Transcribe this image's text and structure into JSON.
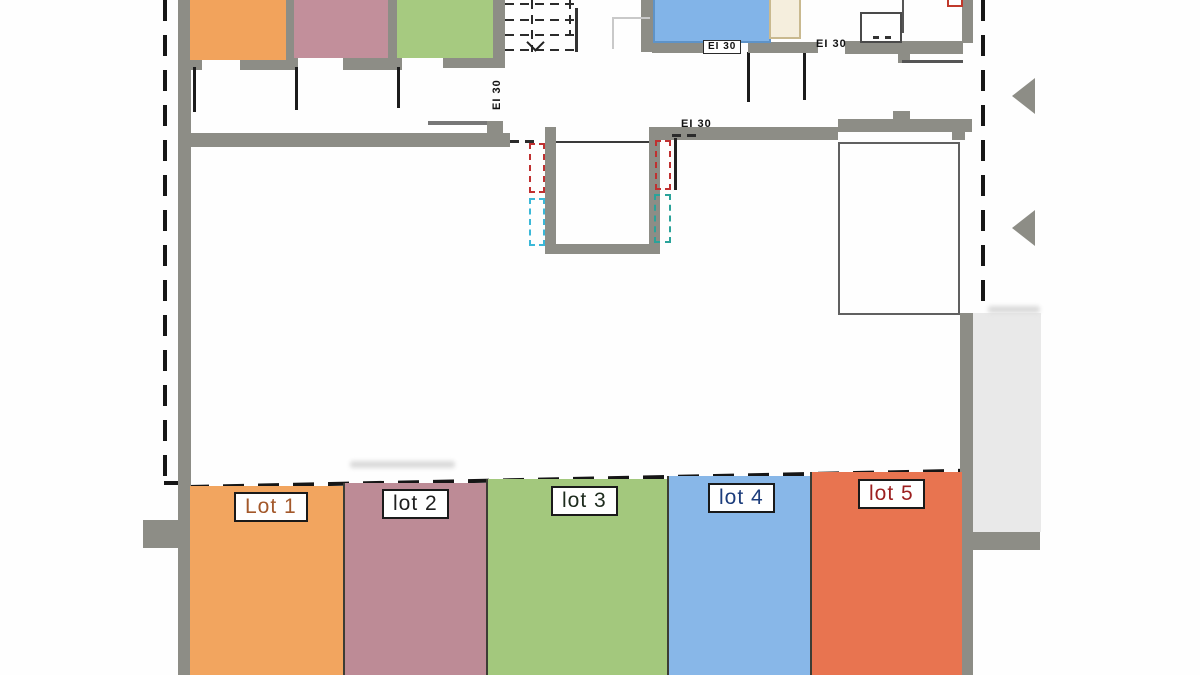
{
  "plan": {
    "fire_rating_label": "EI 30",
    "lots": [
      {
        "id": "lot-1",
        "label": "Lot 1",
        "fill": "#f2a55f",
        "label_color": "#a3582a"
      },
      {
        "id": "lot-2",
        "label": "lot 2",
        "fill": "#bd8b96",
        "label_color": "#1f1f1f"
      },
      {
        "id": "lot-3",
        "label": "lot 3",
        "fill": "#a3c87d",
        "label_color": "#1d2b1d"
      },
      {
        "id": "lot-4",
        "label": "lot 4",
        "fill": "#88b7e8",
        "label_color": "#1c3d7c"
      },
      {
        "id": "lot-5",
        "label": "lot 5",
        "fill": "#e87450",
        "label_color": "#9c1f1f"
      }
    ],
    "rooms": [
      {
        "id": "room-orange",
        "fill": "#f2a35c"
      },
      {
        "id": "room-mauve",
        "fill": "#c28f9b"
      },
      {
        "id": "room-green",
        "fill": "#a6ca80"
      },
      {
        "id": "room-blue",
        "fill": "#82b4e8"
      }
    ],
    "colors": {
      "wall": "#8d8d86",
      "boundary_dash": "#161616",
      "shaft_red": "#c03030",
      "shaft_cyan": "#3bb8d8",
      "shaft_teal": "#2aa39a",
      "paved_area": "#e9e9e9",
      "fixture_beige_fill": "#f5eedd",
      "fixture_beige_border": "#c9b98f",
      "blue_room_border": "#5e93c8",
      "direction_arrow": "#8d8d86"
    },
    "markers": {
      "direction_arrow_count": 2,
      "boundary_endpoint_dot": true
    }
  }
}
